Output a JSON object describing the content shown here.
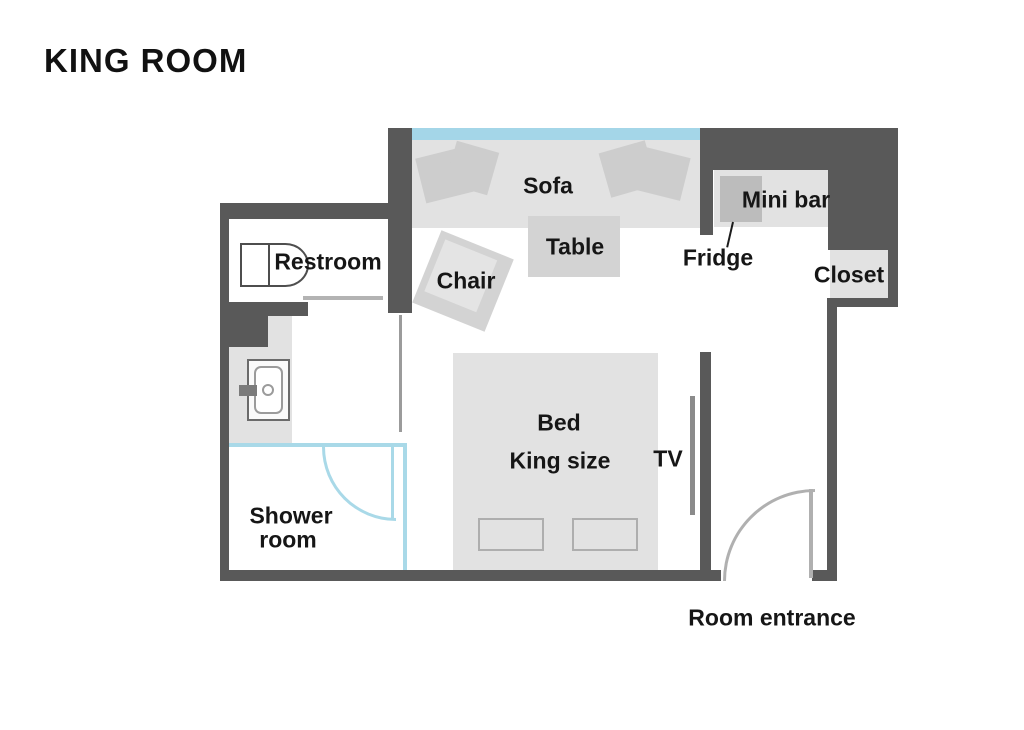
{
  "title": "KING ROOM",
  "plan": {
    "rooms": {
      "restroom": "Restroom",
      "shower_line1": "Shower",
      "shower_line2": "room",
      "closet": "Closet"
    },
    "furniture": {
      "sofa": "Sofa",
      "table": "Table",
      "chair": "Chair",
      "mini_bar": "Mini bar",
      "fridge": "Fridge",
      "bed_line1": "Bed",
      "bed_line2": "King size",
      "tv": "TV"
    },
    "entrance_label": "Room entrance"
  },
  "colors": {
    "wall": "#595959",
    "area": "#e2e2e2",
    "mid": "#d3d3d3",
    "pillow": "#cdcdcd",
    "fridge": "#bcbcbc",
    "window_blue": "#a4d6e8",
    "shower_blue": "#a9d9e8",
    "door_gray": "#b0b0b0",
    "tv_gray": "#8b8b8b",
    "ink": "#161616"
  }
}
